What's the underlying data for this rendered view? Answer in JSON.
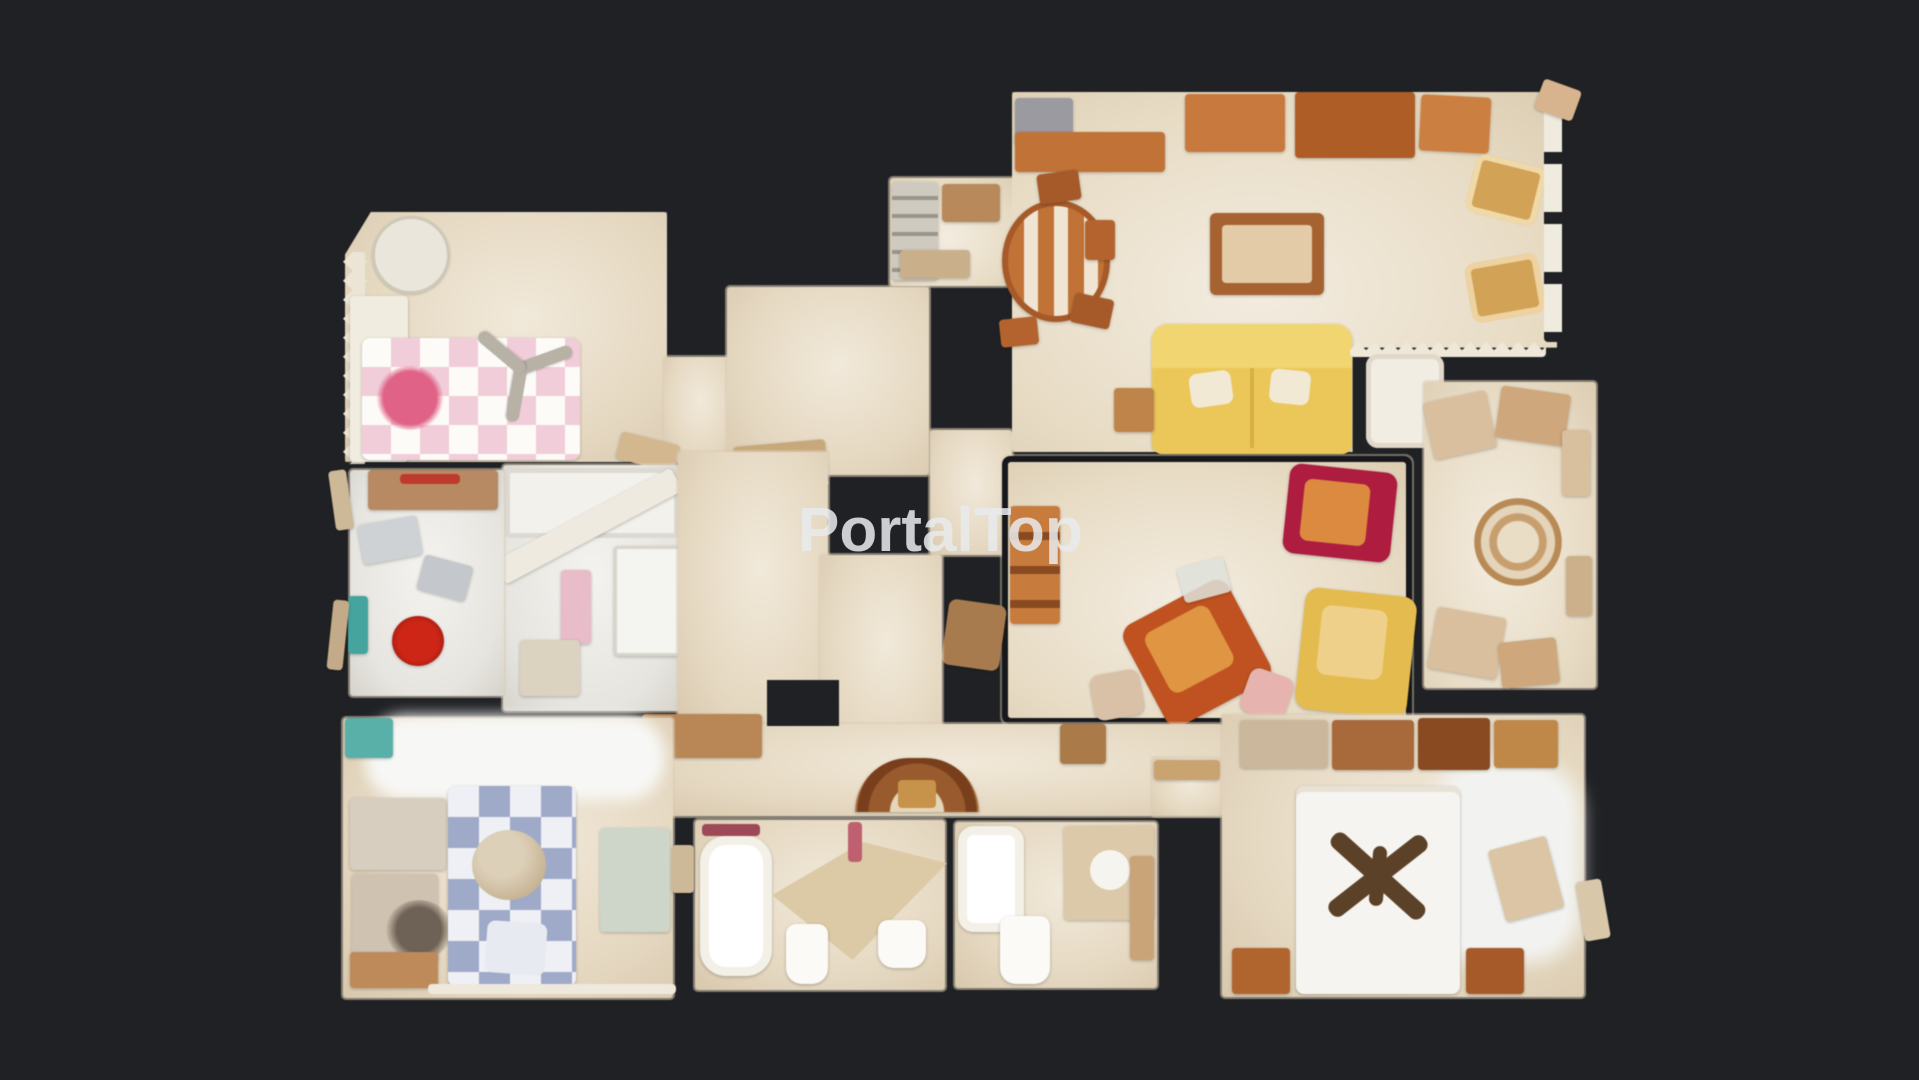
{
  "watermark": {
    "text": "PortalTop"
  },
  "colors": {
    "bg": "#1f2124",
    "floor-light": "#f1e9da",
    "floor-beige": "#e6d9c2",
    "floor-dark": "#d8c8ab",
    "wood": "#c27336",
    "wood-dark": "#8a4a20",
    "sofa-yellow": "#ecc757",
    "armchair-gold": "#d3a254",
    "armchair-crimson": "#b01b40",
    "armchair-orange": "#c1521f",
    "armchair-yellow": "#e5bb4c",
    "bed-pink": "#f2cdd9",
    "bed-pink-accent": "#e26287",
    "bed-blue": "#9fa9c9",
    "linen-white": "#f6f4f0",
    "kitchen-white": "#f2f1ec",
    "red-item": "#d02415",
    "teal-item": "#44a49e",
    "fan-dark": "#5c4128",
    "watermark": "#e9ebee"
  }
}
